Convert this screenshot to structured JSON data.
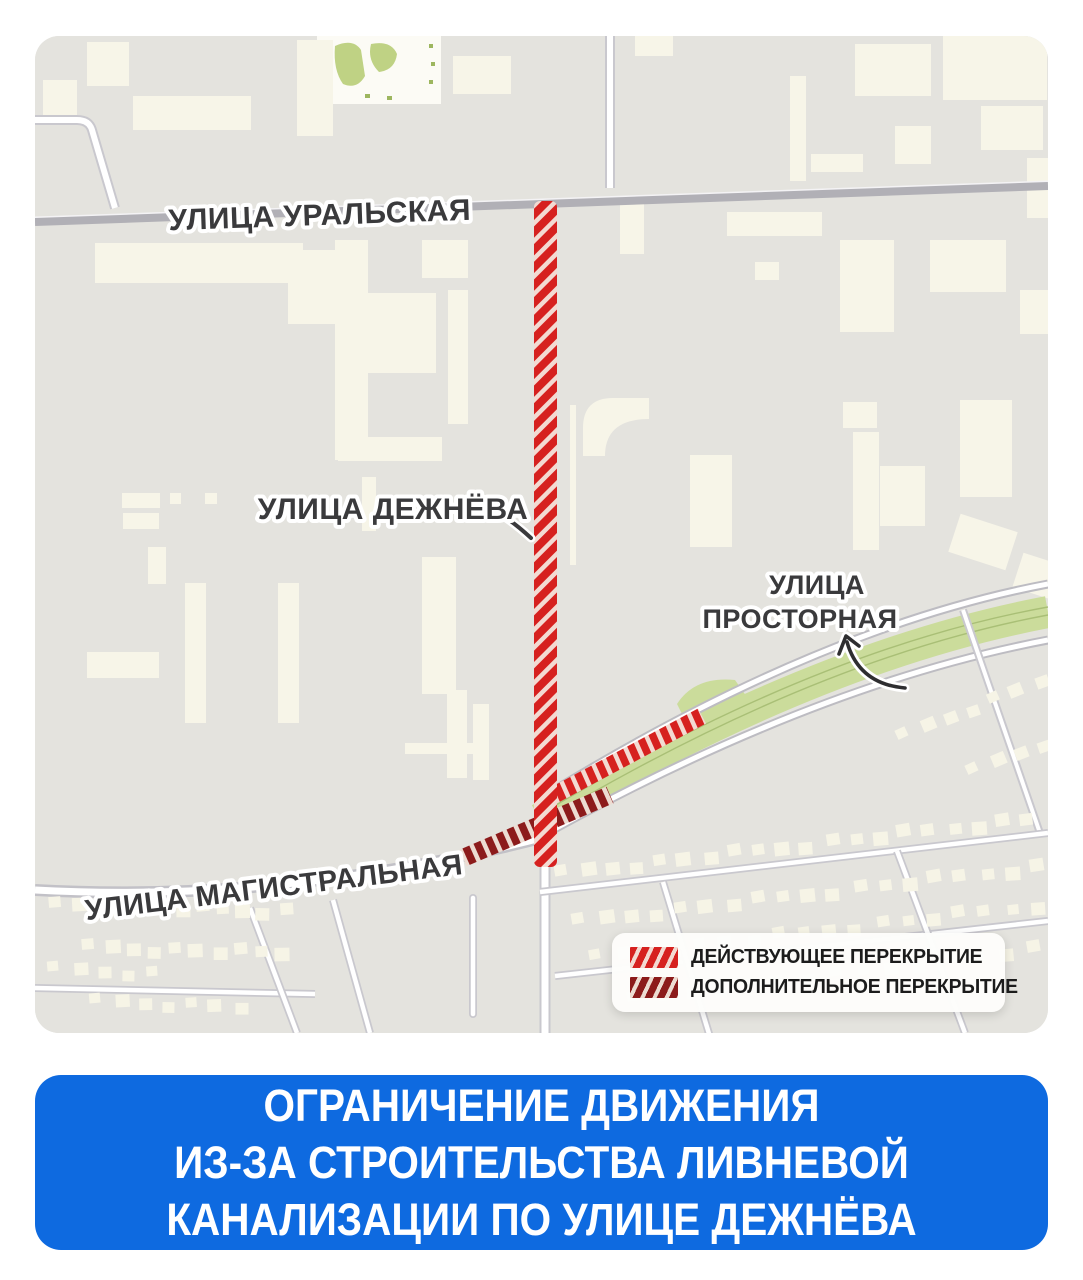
{
  "map": {
    "labels": {
      "uralskaya": "УЛИЦА УРАЛЬСКАЯ",
      "dezhnyova": "УЛИЦА ДЕЖНЁВА",
      "prostornaya_line1": "УЛИЦА",
      "prostornaya_line2": "ПРОСТОРНАЯ",
      "magistralnaya": "УЛИЦА МАГИСТРАЛЬНАЯ"
    },
    "legend": {
      "items": [
        {
          "label": "ДЕЙСТВУЮЩЕЕ ПЕРЕКРЫТИЕ",
          "type": "active"
        },
        {
          "label": "ДОПОЛНИТЕЛЬНОЕ ПЕРЕКРЫТИЕ",
          "type": "additional"
        }
      ]
    }
  },
  "banner": {
    "lines": [
      "ОГРАНИЧЕНИЕ ДВИЖЕНИЯ",
      "ИЗ-ЗА СТРОИТЕЛЬСТВА ЛИВНЕВОЙ",
      "КАНАЛИЗАЦИИ ПО УЛИЦЕ ДЕЖНЁВА"
    ]
  },
  "colors": {
    "active_closure": "#D6211F",
    "active_closure_gap": "#F3DAD2",
    "additional_closure": "#8C1B1B",
    "additional_closure_gap": "#EDDCD2",
    "banner_blue": "#0E6AE0",
    "map_background": "#E4E3DE",
    "building": "#F7F5E8",
    "green_strip": "#CBDC9B"
  }
}
